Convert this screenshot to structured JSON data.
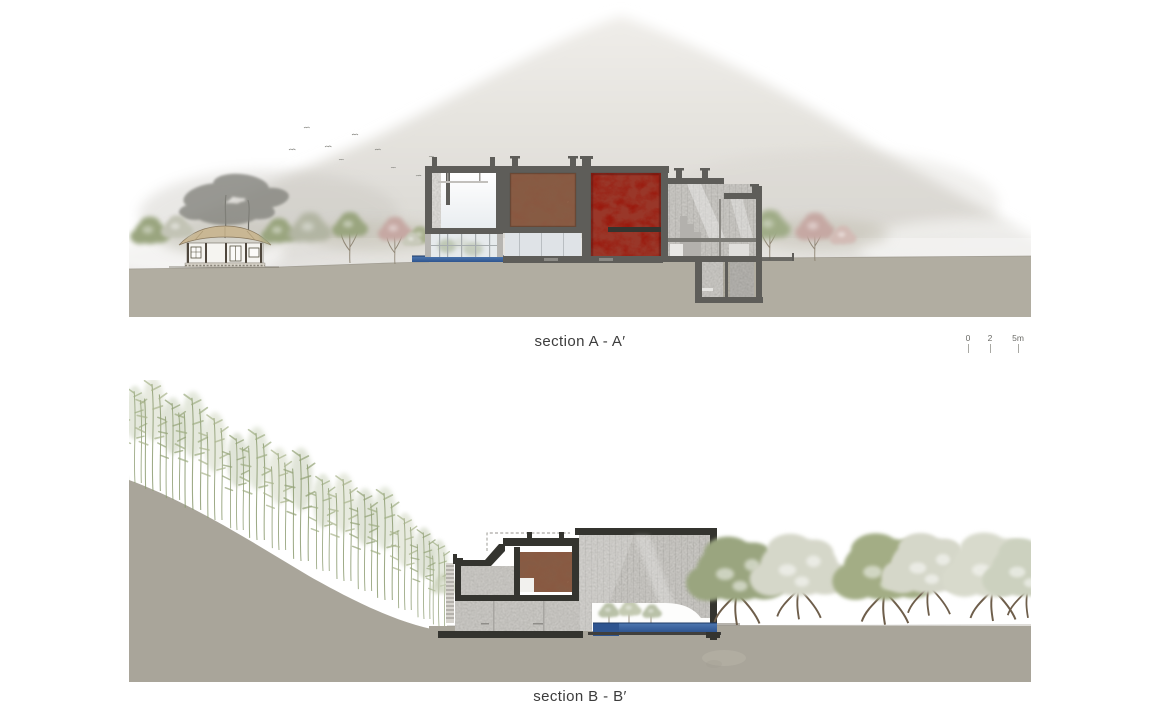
{
  "sheet": {
    "titles": {
      "section_a": "section A - A′",
      "section_b": "section B - B′"
    },
    "scale_bar": {
      "ticks": [
        "0",
        "2",
        "5m"
      ]
    }
  },
  "colors": {
    "page_bg": "#ffffff",
    "ground_upper": "#b1ada1",
    "ground_lower": "#a9a59a",
    "mountain_top": "#efede9",
    "mountain_base": "#d2d0cb",
    "wall_cut": "#5e5d59",
    "wall_cut_dark": "#34342f",
    "concrete": "#c9c7c3",
    "concrete_shadow": "#b2b0ac",
    "glass": "#e6eaec",
    "feature_red": "#9a1a0e",
    "feature_red_deep": "#64100a",
    "earth_brown": "#8a5740",
    "earth_brown_deep": "#583526",
    "water": "#4e78b0",
    "water_deep": "#2f5590",
    "tree_green": "#9aa57f",
    "tree_pale": "#d5d7c9",
    "tree_pink": "#c6a8a3",
    "bamboo": "#9fae83",
    "thatch": "#c9b794",
    "pine": "#84847e",
    "text": "#3c3c3c",
    "tick": "#6a6a66"
  }
}
